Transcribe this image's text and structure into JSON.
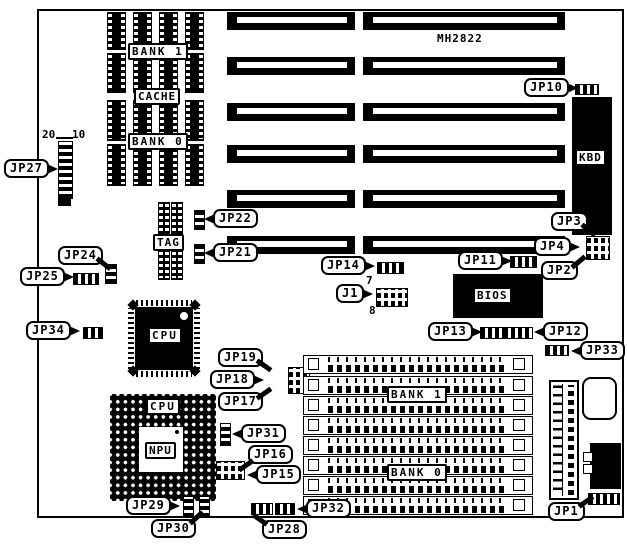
{
  "board": {
    "model": "MH2822"
  },
  "labels": {
    "bank1_chips": "BANK 1",
    "cache": "CACHE",
    "bank0_chips": "BANK 0",
    "tag": "TAG",
    "cpu_qfp": "CPU",
    "cpu_pga": "CPU",
    "npu": "NPU",
    "bios": "BIOS",
    "kbd": "KBD",
    "simm_bank1": "BANK 1",
    "simm_bank0": "BANK 0"
  },
  "pin_numbers": {
    "jp27_pin20": "20",
    "jp27_pin10": "10",
    "j1_pin7": "7",
    "j1_pin8": "8"
  },
  "callouts": {
    "jp1": "JP1",
    "jp2": "JP2",
    "jp3": "JP3",
    "jp4": "JP4",
    "jp10": "JP10",
    "jp11": "JP11",
    "jp12": "JP12",
    "jp13": "JP13",
    "jp14": "JP14",
    "jp15": "JP15",
    "jp16": "JP16",
    "jp17": "JP17",
    "jp18": "JP18",
    "jp19": "JP19",
    "jp21": "JP21",
    "jp22": "JP22",
    "jp24": "JP24",
    "jp25": "JP25",
    "jp27": "JP27",
    "jp28": "JP28",
    "jp29": "JP29",
    "jp30": "JP30",
    "jp31": "JP31",
    "jp32": "JP32",
    "jp33": "JP33",
    "jp34": "JP34",
    "j1": "J1"
  }
}
